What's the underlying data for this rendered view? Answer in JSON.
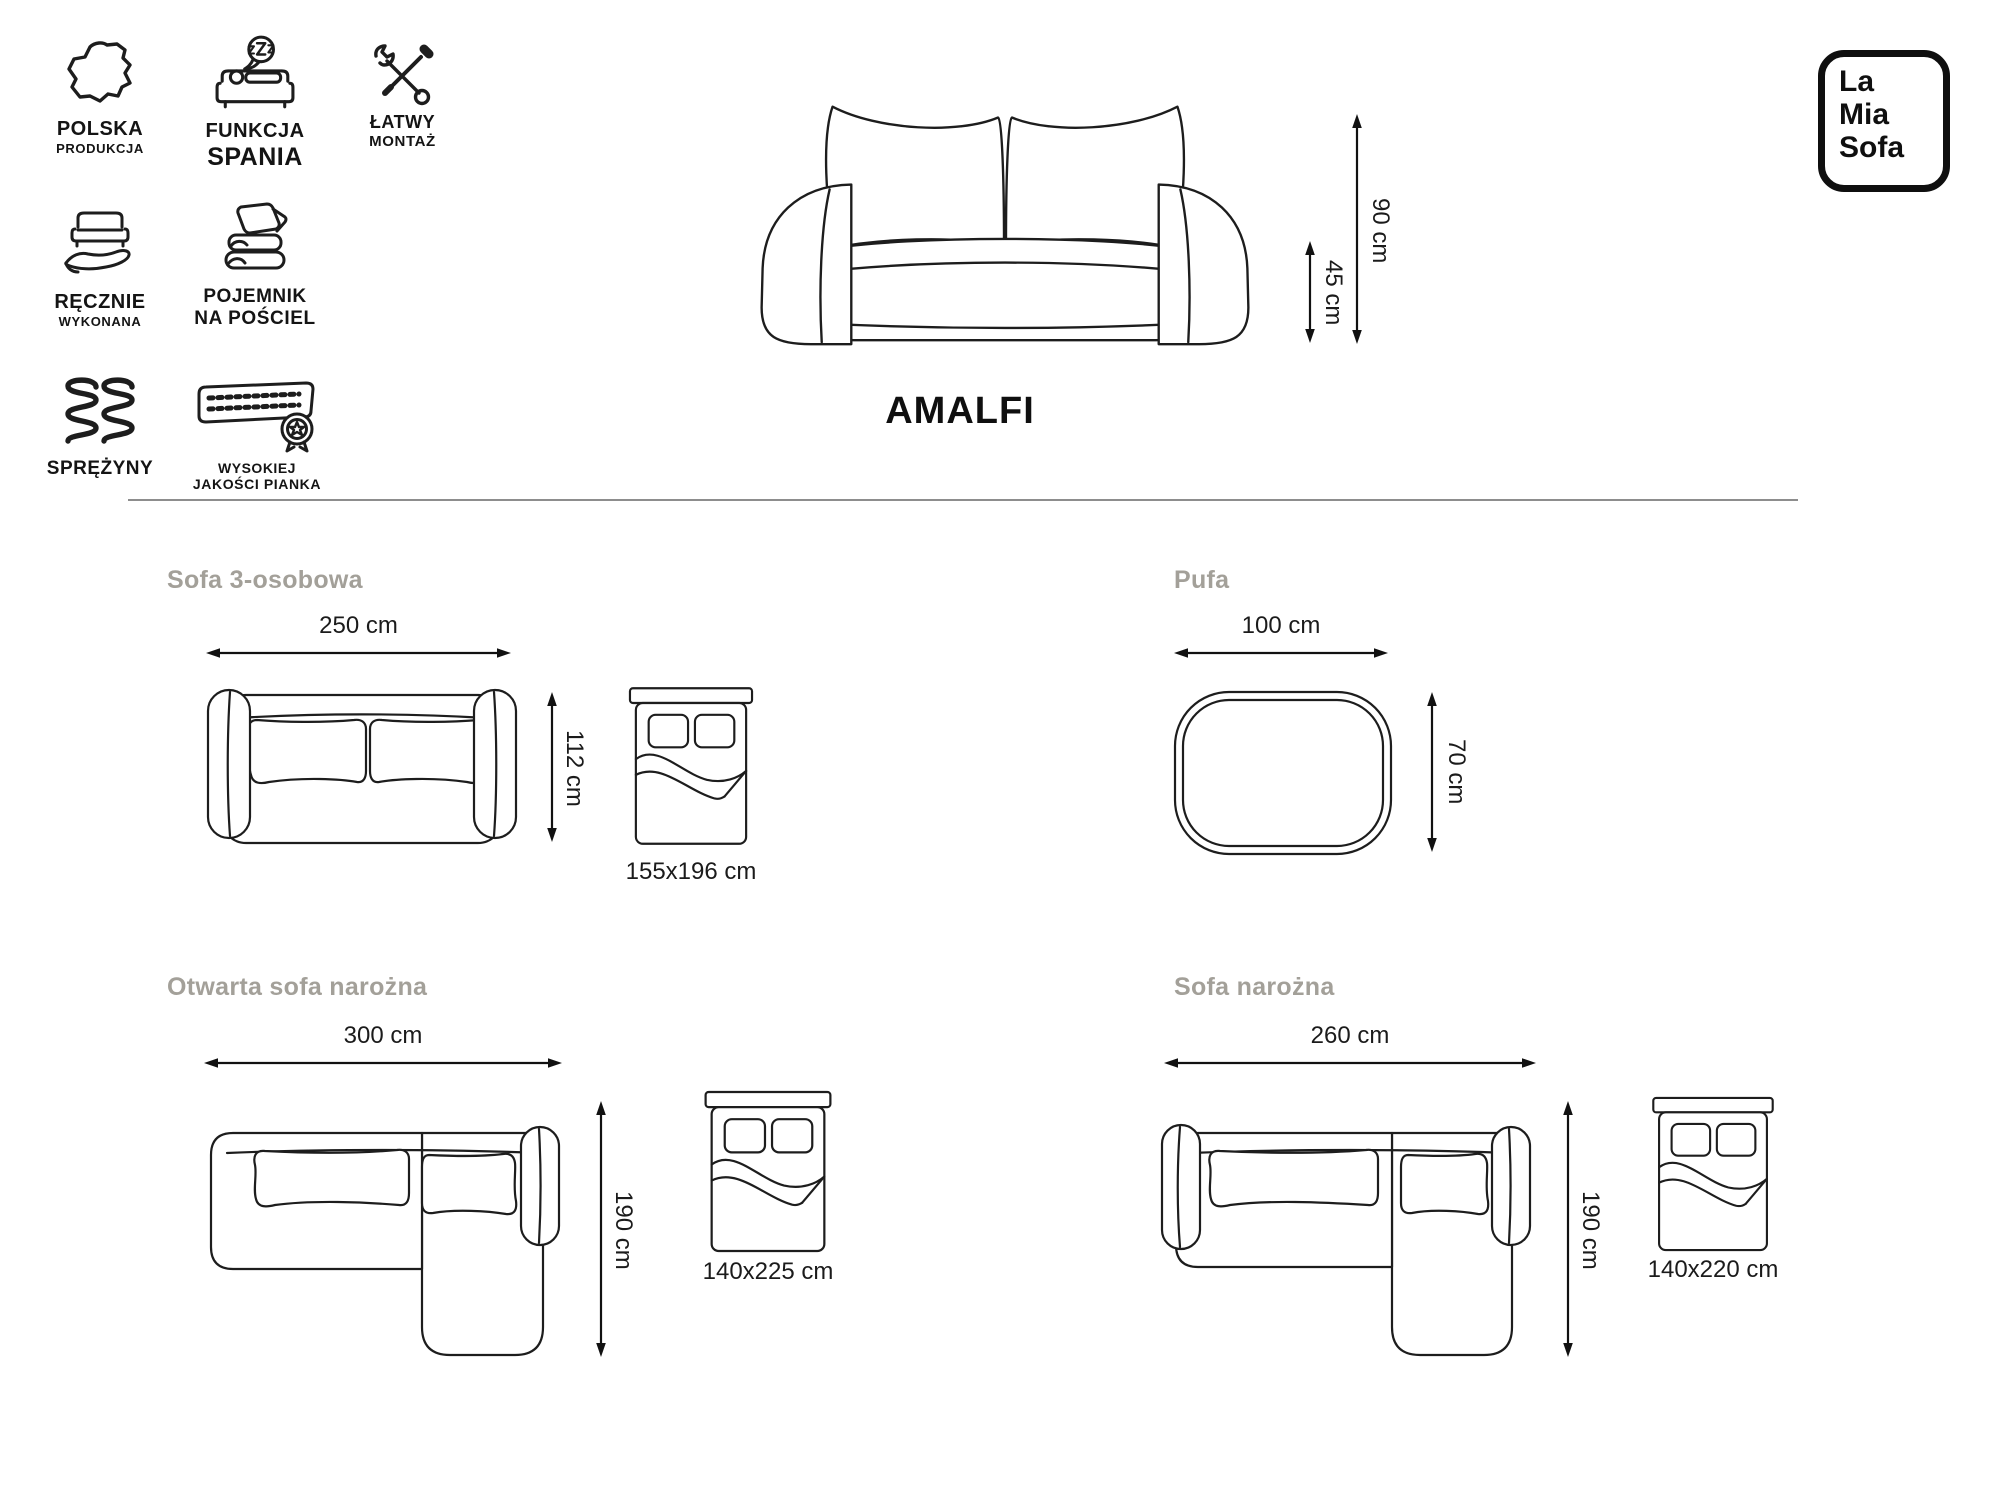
{
  "header": {
    "features": [
      {
        "icon": "poland-map-icon",
        "line1": "POLSKA",
        "line2": "PRODUKCJA"
      },
      {
        "icon": "sleep-function-icon",
        "line1": "FUNKCJA",
        "line2": "SPANIA"
      },
      {
        "icon": "tools-icon",
        "line1": "ŁATWY",
        "line2": "MONTAŻ"
      },
      {
        "icon": "hand-sofa-icon",
        "line1": "RĘCZNIE",
        "line2": "WYKONANA"
      },
      {
        "icon": "bedding-container-icon",
        "line1": "POJEMNIK",
        "line2": "NA POŚCIEL"
      },
      {
        "icon": "springs-icon",
        "line1": "SPRĘŻYNY",
        "line2": ""
      },
      {
        "icon": "quality-foam-icon",
        "line1": "WYSOKIEJ",
        "line2": "JAKOŚCI PIANKA"
      }
    ],
    "product_name": "AMALFI",
    "front_view": {
      "total_height": "90 cm",
      "seat_height": "45 cm"
    },
    "logo": {
      "line1": "La",
      "line2": "Mia",
      "line3": "Sofa"
    }
  },
  "sections": {
    "sofa3": {
      "title": "Sofa 3-osobowa",
      "width": "250 cm",
      "depth": "112 cm",
      "bed_size": "155x196 cm"
    },
    "pufa": {
      "title": "Pufa",
      "width": "100 cm",
      "depth": "70 cm"
    },
    "open_corner": {
      "title": "Otwarta sofa narożna",
      "width": "300 cm",
      "depth": "190 cm",
      "bed_size": "140x225 cm"
    },
    "corner": {
      "title": "Sofa narożna",
      "width": "260 cm",
      "depth": "190 cm",
      "bed_size": "140x220 cm"
    }
  },
  "colors": {
    "line": "#1d1d1d",
    "section_title": "#a3a099",
    "text": "#1b1b1b",
    "divider": "#8d8d8d"
  }
}
